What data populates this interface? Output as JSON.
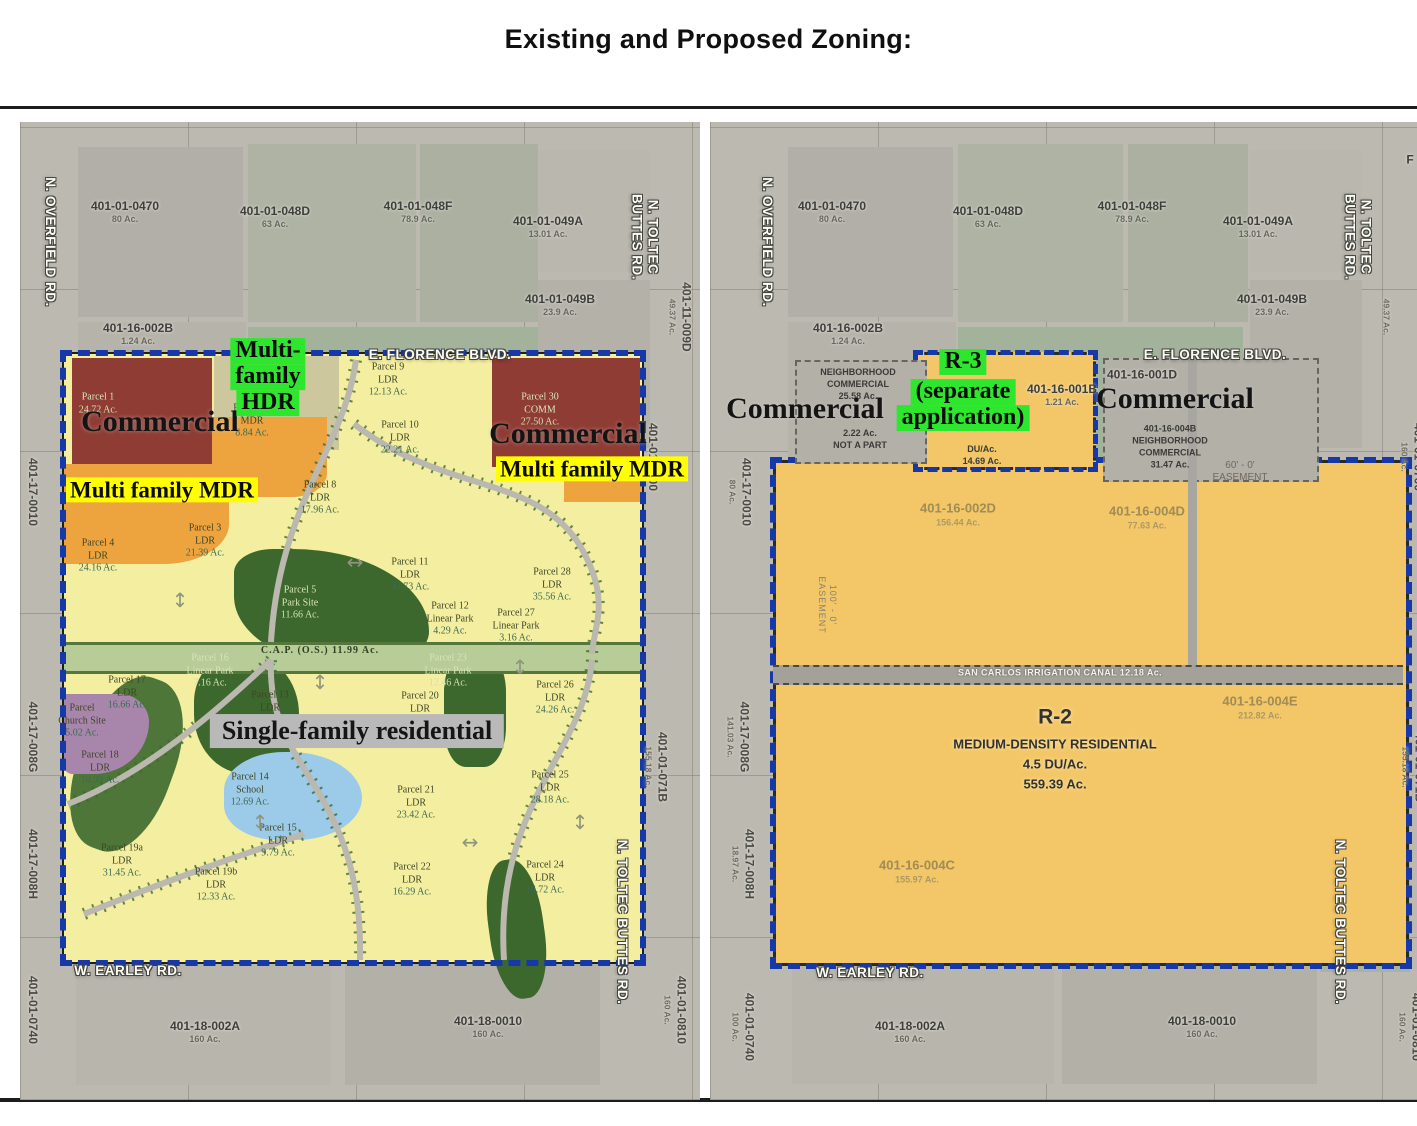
{
  "title": "Existing and Proposed Zoning:",
  "colors": {
    "aerial": "#bcb9b0",
    "ldr_yellow": "#f4efa0",
    "mdr_orange": "#eda33e",
    "commercial_red": "#8f3c34",
    "hdr_tan": "#cdc79e",
    "park_green": "#3c682e",
    "canal_green": "#b7cc96",
    "school_blue": "#9ccae9",
    "church_purple": "#a886ac",
    "r2_amber": "#f3c767",
    "boundary_navy": "#1638a8",
    "highlight_green": "#2ee62e",
    "highlight_yellow": "#ffff00",
    "overlay_gray": "#b9b9b9"
  },
  "maps": {
    "left": {
      "name": "Existing zoning site plan",
      "labels": [
        {
          "x": 105,
          "y": 90,
          "t": "apn",
          "lines": [
            "401-01-0470",
            "80 Ac."
          ]
        },
        {
          "x": 255,
          "y": 95,
          "t": "apn",
          "lines": [
            "401-01-048D",
            "63 Ac."
          ]
        },
        {
          "x": 398,
          "y": 90,
          "t": "apn",
          "lines": [
            "401-01-048F",
            "78.9 Ac."
          ]
        },
        {
          "x": 528,
          "y": 105,
          "t": "apn",
          "lines": [
            "401-01-049A",
            "13.01 Ac."
          ]
        },
        {
          "x": 540,
          "y": 183,
          "t": "apn",
          "lines": [
            "401-01-049B",
            "23.9 Ac."
          ]
        },
        {
          "x": 118,
          "y": 212,
          "t": "apn",
          "lines": [
            "401-16-002B",
            "1.24 Ac."
          ]
        },
        {
          "x": 185,
          "y": 910,
          "t": "apn",
          "lines": [
            "401-18-002A",
            "160 Ac."
          ]
        },
        {
          "x": 468,
          "y": 905,
          "t": "apn",
          "lines": [
            "401-18-0010",
            "160 Ac."
          ]
        },
        {
          "x": 30,
          "y": 120,
          "t": "roadrot",
          "lines": [
            "N. OVERFIELD RD."
          ]
        },
        {
          "x": 625,
          "y": 115,
          "t": "roadrot",
          "lines": [
            "N. TOLTEC",
            "BUTTES RD."
          ]
        },
        {
          "x": 660,
          "y": 195,
          "t": "apnrot",
          "lines": [
            "401-11-009D",
            "49.37 Ac."
          ]
        },
        {
          "x": 12,
          "y": 370,
          "t": "apnrot",
          "lines": [
            "401-17-0010"
          ]
        },
        {
          "x": 12,
          "y": 615,
          "t": "apnrot",
          "lines": [
            "401-17-008G"
          ]
        },
        {
          "x": 12,
          "y": 742,
          "t": "apnrot",
          "lines": [
            "401-17-008H"
          ]
        },
        {
          "x": 12,
          "y": 888,
          "t": "apnrot",
          "lines": [
            "401-01-0740"
          ]
        },
        {
          "x": 632,
          "y": 335,
          "t": "apnrot",
          "lines": [
            "401-01-0700"
          ]
        },
        {
          "x": 636,
          "y": 645,
          "t": "apnrot",
          "lines": [
            "401-01-071B",
            "155.18 Ac."
          ]
        },
        {
          "x": 602,
          "y": 800,
          "t": "roadrot",
          "lines": [
            "N. TOLTEC BUTTES RD."
          ]
        },
        {
          "x": 655,
          "y": 888,
          "t": "apnrot",
          "lines": [
            "401-01-0810",
            "160 Ac."
          ]
        },
        {
          "x": 420,
          "y": 233,
          "t": "road",
          "lines": [
            "E. FLORENCE BLVD."
          ]
        },
        {
          "x": 108,
          "y": 849,
          "t": "road",
          "lines": [
            "W. EARLEY RD."
          ]
        },
        {
          "x": 78,
          "y": 282,
          "t": "plight",
          "lines": [
            "Parcel 1",
            "24.72 Ac."
          ]
        },
        {
          "x": 520,
          "y": 288,
          "t": "plight",
          "lines": [
            "Parcel 30",
            "COMM",
            "27.50 Ac."
          ]
        },
        {
          "x": 368,
          "y": 258,
          "t": "parcel",
          "lines": [
            "Parcel 9",
            "LDR",
            "12.13 Ac."
          ]
        },
        {
          "x": 380,
          "y": 316,
          "t": "parcel",
          "lines": [
            "Parcel 10",
            "LDR",
            "22.21 Ac."
          ]
        },
        {
          "x": 232,
          "y": 299,
          "t": "parcel",
          "lines": [
            "Parcel 31",
            "MDR",
            "8.84 Ac."
          ]
        },
        {
          "x": 300,
          "y": 376,
          "t": "parcel",
          "lines": [
            "Parcel 8",
            "LDR",
            "17.96 Ac."
          ]
        },
        {
          "x": 185,
          "y": 419,
          "t": "parcel",
          "lines": [
            "Parcel 3",
            "LDR",
            "21.39 Ac."
          ]
        },
        {
          "x": 78,
          "y": 434,
          "t": "parcel",
          "lines": [
            "Parcel 4",
            "LDR",
            "24.16 Ac."
          ]
        },
        {
          "x": 390,
          "y": 453,
          "t": "parcel",
          "lines": [
            "Parcel 11",
            "LDR",
            "33.73 Ac."
          ]
        },
        {
          "x": 532,
          "y": 463,
          "t": "parcel",
          "lines": [
            "Parcel 28",
            "LDR",
            "35.56 Ac."
          ]
        },
        {
          "x": 280,
          "y": 481,
          "t": "plight",
          "lines": [
            "Parcel 5",
            "Park Site",
            "11.66 Ac."
          ]
        },
        {
          "x": 430,
          "y": 497,
          "t": "parcel",
          "lines": [
            "Parcel 12",
            "Linear Park",
            "4.29 Ac."
          ]
        },
        {
          "x": 496,
          "y": 504,
          "t": "parcel",
          "lines": [
            "Parcel 27",
            "Linear Park",
            "3.16 Ac."
          ]
        },
        {
          "x": 300,
          "y": 529,
          "t": "canal",
          "lines": [
            "C.A.P. (O.S.) 11.99 Ac."
          ]
        },
        {
          "x": 190,
          "y": 549,
          "t": "plight",
          "lines": [
            "Parcel 16",
            "Linear Park",
            "7.16 Ac."
          ]
        },
        {
          "x": 107,
          "y": 571,
          "t": "parcel",
          "lines": [
            "Parcel 17",
            "LDR",
            "16.66 Ac."
          ]
        },
        {
          "x": 250,
          "y": 586,
          "t": "parcel",
          "lines": [
            "Parcel 13",
            "LDR",
            "24.46 Ac."
          ]
        },
        {
          "x": 428,
          "y": 549,
          "t": "plight",
          "lines": [
            "Parcel 23",
            "Linear Park",
            "12.46 Ac."
          ]
        },
        {
          "x": 535,
          "y": 576,
          "t": "parcel",
          "lines": [
            "Parcel 26",
            "LDR",
            "24.26 Ac."
          ]
        },
        {
          "x": 400,
          "y": 581,
          "t": "parcel",
          "lines": [
            "Parcel 20",
            "LDR"
          ]
        },
        {
          "x": 62,
          "y": 599,
          "t": "parcel",
          "lines": [
            "Parcel",
            "Church Site",
            "5.02 Ac."
          ]
        },
        {
          "x": 80,
          "y": 646,
          "t": "parcel",
          "lines": [
            "Parcel 18",
            "LDR",
            "10.39 Ac."
          ]
        },
        {
          "x": 230,
          "y": 668,
          "t": "parcel",
          "lines": [
            "Parcel 14",
            "School",
            "12.69 Ac."
          ]
        },
        {
          "x": 396,
          "y": 681,
          "t": "parcel",
          "lines": [
            "Parcel 21",
            "LDR",
            "23.42 Ac."
          ]
        },
        {
          "x": 530,
          "y": 666,
          "t": "parcel",
          "lines": [
            "Parcel 25",
            "LDR",
            "28.18 Ac."
          ]
        },
        {
          "x": 258,
          "y": 719,
          "t": "parcel",
          "lines": [
            "Parcel 15",
            "LDR",
            "9.79 Ac."
          ]
        },
        {
          "x": 102,
          "y": 739,
          "t": "parcel",
          "lines": [
            "Parcel 19a",
            "LDR",
            "31.45 Ac."
          ]
        },
        {
          "x": 196,
          "y": 763,
          "t": "parcel",
          "lines": [
            "Parcel 19b",
            "LDR",
            "12.33 Ac."
          ]
        },
        {
          "x": 392,
          "y": 758,
          "t": "parcel",
          "lines": [
            "Parcel 22",
            "LDR",
            "16.29 Ac."
          ]
        },
        {
          "x": 525,
          "y": 756,
          "t": "parcel",
          "lines": [
            "Parcel 24",
            "LDR",
            "16.72 Ac."
          ]
        },
        {
          "x": 502,
          "y": 347,
          "t": "parcel",
          "lines": [
            "7.30 Ac."
          ]
        },
        {
          "x": 140,
          "y": 300,
          "t": "serifblk",
          "lines": [
            "Commercial"
          ]
        },
        {
          "x": 548,
          "y": 312,
          "t": "serifblk",
          "lines": [
            "Commercial"
          ]
        },
        {
          "x": 248,
          "y": 255,
          "t": "hlg",
          "lines": [
            "Multi-",
            "family",
            "HDR"
          ]
        },
        {
          "x": 142,
          "y": 368,
          "t": "hly",
          "lines": [
            "Multi family MDR"
          ]
        },
        {
          "x": 572,
          "y": 347,
          "t": "hly",
          "lines": [
            "Multi family MDR"
          ]
        },
        {
          "x": 337,
          "y": 609,
          "t": "hlgray",
          "lines": [
            "Single-family residential"
          ]
        },
        {
          "x": 160,
          "y": 478,
          "t": "arrow",
          "lines": [
            "↕"
          ]
        },
        {
          "x": 335,
          "y": 440,
          "t": "arrow",
          "lines": [
            "↔"
          ]
        },
        {
          "x": 300,
          "y": 560,
          "t": "arrow",
          "lines": [
            "↕"
          ]
        },
        {
          "x": 500,
          "y": 545,
          "t": "arrow",
          "lines": [
            "↕"
          ]
        },
        {
          "x": 240,
          "y": 700,
          "t": "arrow",
          "lines": [
            "↕"
          ]
        },
        {
          "x": 450,
          "y": 720,
          "t": "arrow",
          "lines": [
            "↔"
          ]
        },
        {
          "x": 560,
          "y": 700,
          "t": "arrow",
          "lines": [
            "↕"
          ]
        }
      ]
    },
    "right": {
      "name": "Proposed zoning",
      "labels": [
        {
          "x": 122,
          "y": 90,
          "t": "apn",
          "lines": [
            "401-01-0470",
            "80 Ac."
          ]
        },
        {
          "x": 278,
          "y": 95,
          "t": "apn",
          "lines": [
            "401-01-048D",
            "63 Ac."
          ]
        },
        {
          "x": 422,
          "y": 90,
          "t": "apn",
          "lines": [
            "401-01-048F",
            "78.9 Ac."
          ]
        },
        {
          "x": 548,
          "y": 105,
          "t": "apn",
          "lines": [
            "401-01-049A",
            "13.01 Ac."
          ]
        },
        {
          "x": 562,
          "y": 183,
          "t": "apn",
          "lines": [
            "401-01-049B",
            "23.9 Ac."
          ]
        },
        {
          "x": 138,
          "y": 212,
          "t": "apn",
          "lines": [
            "401-16-002B",
            "1.24 Ac."
          ]
        },
        {
          "x": 200,
          "y": 910,
          "t": "apn",
          "lines": [
            "401-18-002A",
            "160 Ac."
          ]
        },
        {
          "x": 492,
          "y": 905,
          "t": "apn",
          "lines": [
            "401-18-0010",
            "160 Ac."
          ]
        },
        {
          "x": 57,
          "y": 120,
          "t": "roadrot",
          "lines": [
            "N. OVERFIELD RD."
          ]
        },
        {
          "x": 648,
          "y": 115,
          "t": "roadrot",
          "lines": [
            "N. TOLTEC",
            "BUTTES RD."
          ]
        },
        {
          "x": 676,
          "y": 195,
          "t": "apnrot",
          "lines": [
            "49.37 Ac."
          ]
        },
        {
          "x": 700,
          "y": 38,
          "t": "apn",
          "lines": [
            "F"
          ]
        },
        {
          "x": 30,
          "y": 370,
          "t": "apnrot",
          "lines": [
            "401-17-0010",
            "80 Ac."
          ]
        },
        {
          "x": 28,
          "y": 615,
          "t": "apnrot",
          "lines": [
            "401-17-008G",
            "141.03 Ac."
          ]
        },
        {
          "x": 33,
          "y": 742,
          "t": "apnrot",
          "lines": [
            "401-17-008H",
            "18.97 Ac."
          ]
        },
        {
          "x": 33,
          "y": 905,
          "t": "apnrot",
          "lines": [
            "401-01-0740",
            "100 Ac."
          ]
        },
        {
          "x": 702,
          "y": 335,
          "t": "apnrot",
          "lines": [
            "401-01-0700",
            "160 Ac."
          ]
        },
        {
          "x": 703,
          "y": 645,
          "t": "apnrot",
          "lines": [
            "401-01-071B",
            "155.18 Ac."
          ]
        },
        {
          "x": 630,
          "y": 800,
          "t": "roadrot",
          "lines": [
            "N. TOLTEC BUTTES RD."
          ]
        },
        {
          "x": 700,
          "y": 905,
          "t": "apnrot",
          "lines": [
            "401-01-0810",
            "160 Ac."
          ]
        },
        {
          "x": 505,
          "y": 233,
          "t": "road",
          "lines": [
            "E. FLORENCE BLVD."
          ]
        },
        {
          "x": 160,
          "y": 851,
          "t": "road",
          "lines": [
            "W. EARLEY RD."
          ]
        },
        {
          "x": 148,
          "y": 262,
          "t": "ncs",
          "lines": [
            "NEIGHBORHOOD",
            "COMMERCIAL",
            "25.58 Ac."
          ]
        },
        {
          "x": 95,
          "y": 287,
          "t": "serifblk",
          "lines": [
            "Commercial"
          ]
        },
        {
          "x": 150,
          "y": 317,
          "t": "ncs",
          "lines": [
            "2.22 Ac.",
            "NOT A PART"
          ]
        },
        {
          "x": 253,
          "y": 240,
          "t": "hlg",
          "lines": [
            "R-3"
          ]
        },
        {
          "x": 253,
          "y": 283,
          "t": "hlg",
          "lines": [
            "(separate",
            "application)"
          ]
        },
        {
          "x": 272,
          "y": 333,
          "t": "ncs",
          "lines": [
            "DU/Ac.",
            "14.69 Ac."
          ]
        },
        {
          "x": 352,
          "y": 273,
          "t": "apn",
          "lines": [
            "401-16-001B",
            "1.21 Ac."
          ]
        },
        {
          "x": 432,
          "y": 253,
          "t": "apn",
          "lines": [
            "401-16-001D"
          ]
        },
        {
          "x": 465,
          "y": 277,
          "t": "serifblk",
          "lines": [
            "Commercial"
          ]
        },
        {
          "x": 460,
          "y": 325,
          "t": "ncs",
          "lines": [
            "401-16-004B",
            "NEIGHBORHOOD",
            "COMMERCIAL",
            "31.47 Ac."
          ]
        },
        {
          "x": 530,
          "y": 350,
          "t": "ease",
          "lines": [
            "60' - 0'",
            "EASEMENT"
          ]
        },
        {
          "x": 248,
          "y": 393,
          "t": "apnf",
          "lines": [
            "401-16-002D",
            "156.44 Ac."
          ]
        },
        {
          "x": 437,
          "y": 396,
          "t": "apnf",
          "lines": [
            "401-16-004D",
            "77.63 Ac."
          ]
        },
        {
          "x": 117,
          "y": 483,
          "t": "easerot",
          "lines": [
            "100' - 0'",
            "EASEMENT"
          ]
        },
        {
          "x": 350,
          "y": 551,
          "t": "canalw",
          "lines": [
            "SAN CARLOS IRRIGATION CANAL  12.18 Ac."
          ]
        },
        {
          "x": 550,
          "y": 586,
          "t": "apnf",
          "lines": [
            "401-16-004E",
            "212.82 Ac."
          ]
        },
        {
          "x": 345,
          "y": 626,
          "t": "r2",
          "lines": [
            "R-2",
            "MEDIUM-DENSITY RESIDENTIAL",
            "4.5 DU/Ac.",
            "559.39 Ac."
          ]
        },
        {
          "x": 207,
          "y": 750,
          "t": "apnf",
          "lines": [
            "401-16-004C",
            "155.97 Ac."
          ]
        }
      ]
    }
  }
}
